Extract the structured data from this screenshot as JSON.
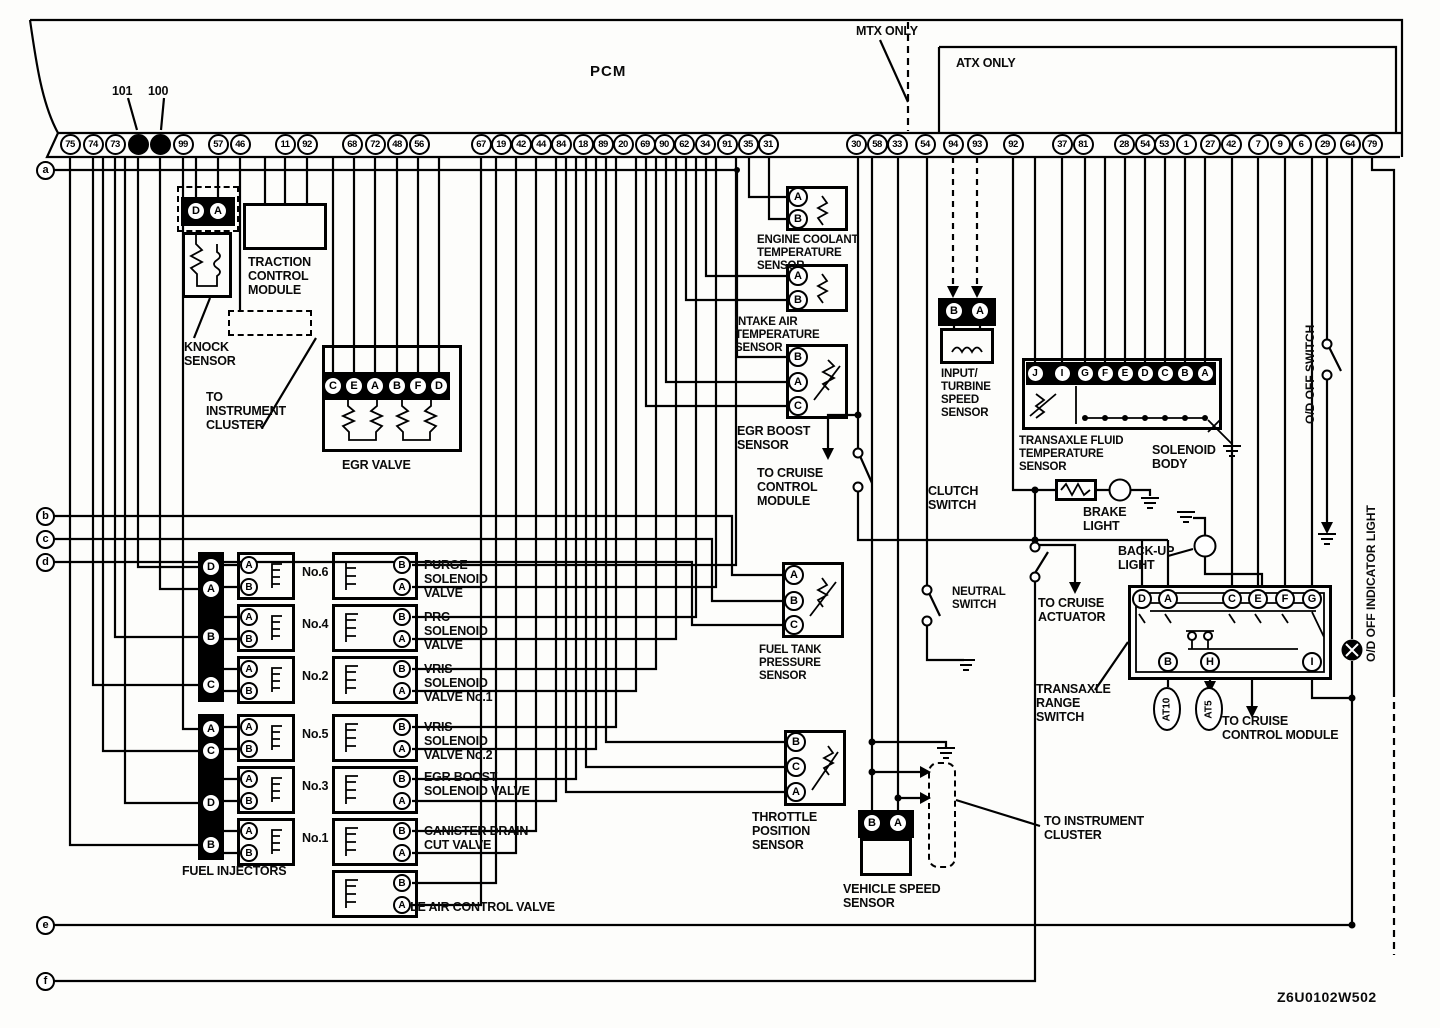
{
  "title": "PCM wiring diagram",
  "pcm": {
    "label": "PCM",
    "mtx_label": "MTX ONLY",
    "atx_label": "ATX ONLY",
    "callouts": [
      "101",
      "100"
    ],
    "pins": [
      "75",
      "74",
      "73",
      "101",
      "100",
      "99",
      "57",
      "46",
      "11",
      "92",
      "68",
      "72",
      "48",
      "56",
      "67",
      "19",
      "42",
      "44",
      "84",
      "18",
      "89",
      "20",
      "69",
      "90",
      "62",
      "34",
      "91",
      "35",
      "31",
      "30",
      "58",
      "33",
      "54",
      "94",
      "93",
      "92",
      "37",
      "81",
      "28",
      "54",
      "53",
      "1",
      "27",
      "42",
      "7",
      "9",
      "6",
      "29",
      "64",
      "79"
    ],
    "filled_pins": [
      3,
      4
    ]
  },
  "side_ports": [
    "a",
    "b",
    "c",
    "d",
    "e",
    "f"
  ],
  "components": {
    "knock_sensor": {
      "label": "KNOCK\nSENSOR",
      "pins": [
        "D",
        "A"
      ]
    },
    "traction_control_module": {
      "label": "TRACTION\nCONTROL\nMODULE"
    },
    "to_instrument_cluster_left": {
      "label": "TO\nINSTRUMENT\nCLUSTER"
    },
    "egr_valve": {
      "label": "EGR VALVE",
      "pins": [
        "C",
        "E",
        "A",
        "B",
        "F",
        "D"
      ]
    },
    "fuel_injectors": {
      "label": "FUEL INJECTORS",
      "strip1_pins": [
        "D",
        "A",
        "B",
        "C"
      ],
      "strip2_pins": [
        "A",
        "C",
        "D",
        "B"
      ],
      "unit_pins": [
        "A",
        "B"
      ],
      "numbers": [
        "No.6",
        "No.4",
        "No.2",
        "No.5",
        "No.3",
        "No.1"
      ]
    },
    "purge_valve": {
      "label": "PURGE\nSOLENOID\nVALVE",
      "pins": [
        "B",
        "A"
      ]
    },
    "prc_valve": {
      "label": "PRC\nSOLENOID\nVALVE",
      "pins": [
        "B",
        "A"
      ]
    },
    "vris1_valve": {
      "label": "VRIS\nSOLENOID\nVALVE No.1",
      "pins": [
        "B",
        "A"
      ]
    },
    "vris2_valve": {
      "label": "VRIS\nSOLENOID\nVALVE No.2",
      "pins": [
        "B",
        "A"
      ]
    },
    "egr_boost_valve": {
      "label": "EGR BOOST\nSOLENOID VALVE",
      "pins": [
        "B",
        "A"
      ]
    },
    "canister_valve": {
      "label": "CANISTER DRAIN\nCUT VALVE",
      "pins": [
        "B",
        "A"
      ]
    },
    "iac_valve": {
      "label": "IDLE AIR CONTROL VALVE",
      "pins": [
        "B",
        "A"
      ]
    },
    "ect_sensor": {
      "label": "ENGINE COOLANT\nTEMPERATURE\nSENSOR",
      "pins": [
        "A",
        "B"
      ]
    },
    "iat_sensor": {
      "label": "INTAKE AIR\nTEMPERATURE\nSENSOR",
      "pins": [
        "A",
        "B"
      ]
    },
    "egr_boost_sensor": {
      "label": "EGR BOOST\nSENSOR",
      "pins": [
        "B",
        "A",
        "C"
      ]
    },
    "to_cruise_control_module_center": {
      "label": "TO CRUISE\nCONTROL\nMODULE"
    },
    "clutch_switch": {
      "label": "CLUTCH\nSWITCH"
    },
    "neutral_switch": {
      "label": "NEUTRAL\nSWITCH"
    },
    "fuel_tank_pressure_sensor": {
      "label": "FUEL TANK\nPRESSURE\nSENSOR",
      "pins": [
        "A",
        "B",
        "C"
      ]
    },
    "throttle_position_sensor": {
      "label": "THROTTLE\nPOSITION\nSENSOR",
      "pins": [
        "B",
        "C",
        "A"
      ]
    },
    "vehicle_speed_sensor": {
      "label": "VEHICLE SPEED\nSENSOR",
      "pins": [
        "B",
        "A"
      ]
    },
    "to_instrument_cluster_right": {
      "label": "TO INSTRUMENT\nCLUSTER"
    },
    "input_turbine_speed_sensor": {
      "label": "INPUT/\nTURBINE\nSPEED\nSENSOR",
      "pins": [
        "B",
        "A"
      ]
    },
    "transaxle_fluid_temp_sensor": {
      "label": "TRANSAXLE FLUID\nTEMPERATURE\nSENSOR"
    },
    "solenoid_body": {
      "label": "SOLENOID\nBODY",
      "pins": [
        "J",
        "I",
        "G",
        "F",
        "E",
        "D",
        "C",
        "B",
        "A"
      ]
    },
    "brake_light": {
      "label": "BRAKE\nLIGHT"
    },
    "backup_light": {
      "label": "BACK-UP\nLIGHT"
    },
    "to_cruise_actuator": {
      "label": "TO CRUISE\nACTUATOR"
    },
    "transaxle_range_switch": {
      "label": "TRANSAXLE\nRANGE\nSWITCH",
      "top_pins": [
        "D",
        "A",
        "C",
        "E",
        "F",
        "G"
      ],
      "bottom_pins": [
        "B",
        "H",
        "I"
      ],
      "at10_label": "AT10",
      "at5_label": "AT5"
    },
    "to_cruise_control_module_right": {
      "label": "TO CRUISE\nCONTROL MODULE"
    },
    "od_off_switch": {
      "label": "O/D OFF SWITCH"
    },
    "od_off_indicator_light": {
      "label": "O/D OFF INDICATOR LIGHT"
    }
  },
  "footer_code": "Z6U0102W502"
}
